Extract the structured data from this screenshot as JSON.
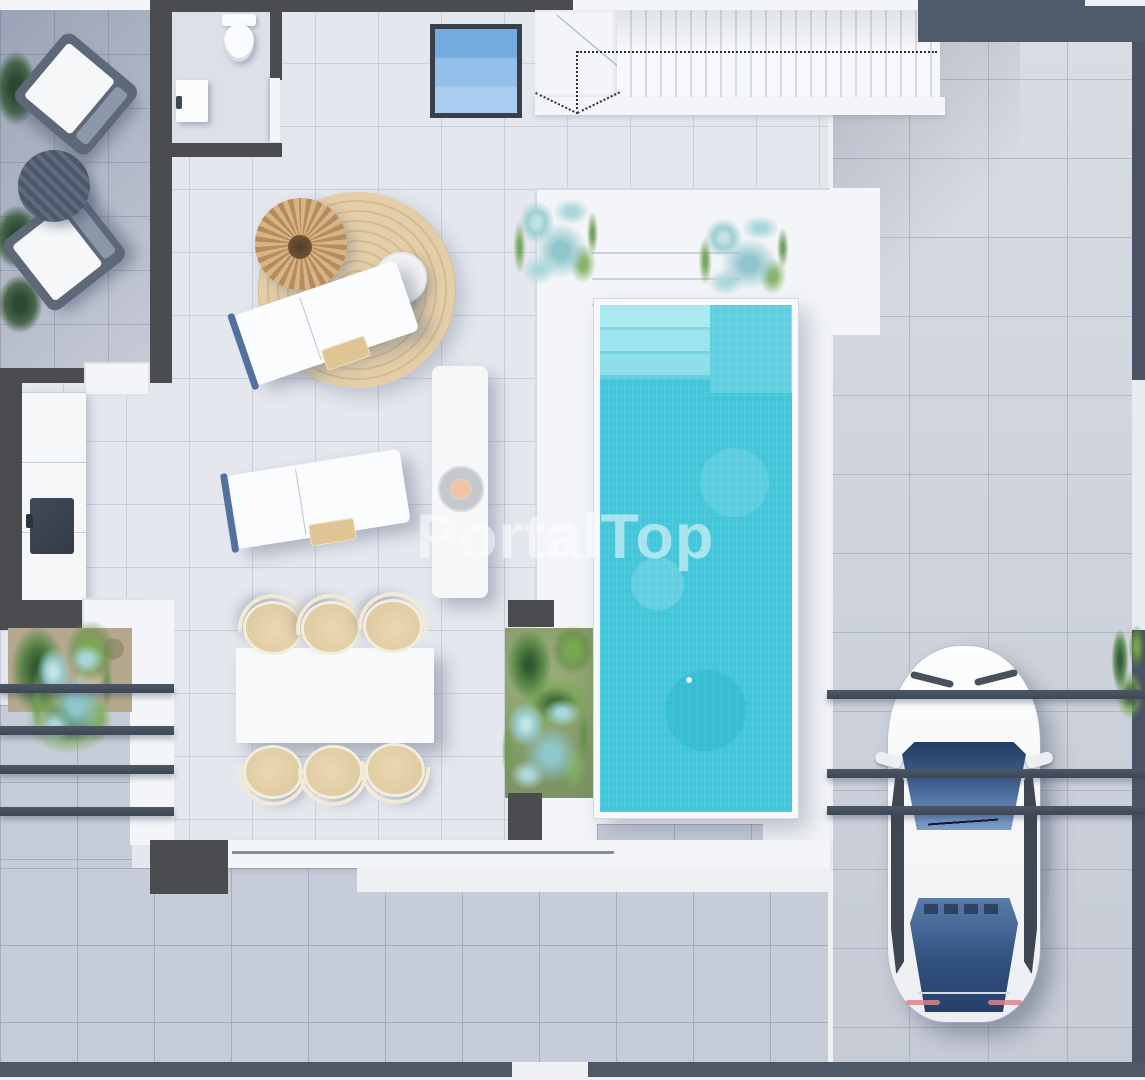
{
  "watermark": {
    "text": "PortalTop"
  },
  "scene": {
    "type": "floor-plan-3d-render",
    "view": "top-down",
    "areas": [
      {
        "name": "side-terrace",
        "position": "top-left",
        "furniture": [
          "outdoor-armchair",
          "outdoor-armchair",
          "round-coffee-table"
        ]
      },
      {
        "name": "bathroom",
        "position": "top-left",
        "fixtures": [
          "toilet",
          "sink-cabinet",
          "door"
        ]
      },
      {
        "name": "living-terrace",
        "position": "center-left",
        "furniture": [
          "round-jute-rug",
          "rattan-pouf",
          "side-table",
          "sun-lounger",
          "sun-lounger",
          "fire-bowl-console"
        ]
      },
      {
        "name": "kitchen",
        "position": "left",
        "fixtures": [
          "counter",
          "cooktop-sink",
          "window",
          "window"
        ]
      },
      {
        "name": "dining-area",
        "position": "bottom-left",
        "furniture": [
          "dining-table"
        ],
        "chairs": 6
      },
      {
        "name": "staircase",
        "position": "top-center",
        "direction_arrow": "dotted"
      },
      {
        "name": "skylight",
        "position": "top-center"
      },
      {
        "name": "pool-deck",
        "position": "center-right",
        "planters": 3,
        "wide_steps": 3
      },
      {
        "name": "swimming-pool",
        "position": "center-right",
        "features": [
          "entry-steps",
          "mosaic-tiles",
          "tanning-shelf"
        ]
      },
      {
        "name": "driveway-carport",
        "position": "right",
        "vehicle": "white-car",
        "pergola_beams": 3
      },
      {
        "name": "side-yard-pergola",
        "position": "bottom-left",
        "pergola_beams": 4,
        "planter": "palms-and-succulents"
      },
      {
        "name": "rear-patio",
        "position": "bottom"
      }
    ],
    "colors": {
      "pool_water": "#43c6da",
      "pool_steps": "#93e0ea",
      "deck_white": "#f3f5f8",
      "floor_light": "#e4e7ed",
      "floor_medium": "#c7cdd8",
      "terrace_gray": "#a6aec0",
      "driveway": "#d5d9e0",
      "wall_dark": "#4a4c4f",
      "wall_blue": "#4f5a6b",
      "rug": "#ddc69e",
      "pouf": "#c9a06c",
      "chair_beige": "#e5d2ab",
      "plant_green": "#6f9e4a",
      "plant_blue": "#9ccdd2",
      "car_glass": "#35568c",
      "skylight": "#82b5e6",
      "watermark_color": "rgba(255,255,255,0.55)"
    }
  }
}
